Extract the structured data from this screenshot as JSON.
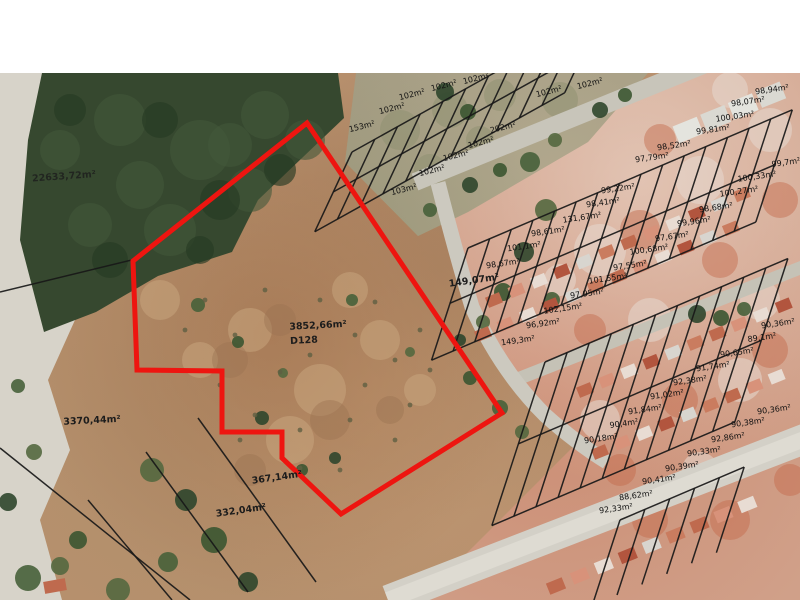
{
  "map": {
    "description": "aerial cadastral map",
    "subject_parcel": {
      "area_label": "3852,66m²",
      "code": "D128",
      "outline_color": "#ee1510",
      "outline_points": "307,123 133,261 137,370 222,371 222,432 282,432 282,458 341,514 502,413"
    },
    "parcel_line_color": "#181818",
    "labels": [
      {
        "text": "22633,72m²",
        "x": 64,
        "y": 177,
        "rot": -4,
        "big": true,
        "dim": true
      },
      {
        "text": "3370,44m²",
        "x": 92,
        "y": 421,
        "rot": -3,
        "big": true
      },
      {
        "text": "3852,66m²",
        "x": 318,
        "y": 326,
        "rot": -3,
        "big": true
      },
      {
        "text": "D128",
        "x": 304,
        "y": 341,
        "rot": -3,
        "big": true
      },
      {
        "text": "367,14m²",
        "x": 277,
        "y": 478,
        "rot": -8,
        "big": true
      },
      {
        "text": "332,04m²",
        "x": 241,
        "y": 511,
        "rot": -8,
        "big": true
      },
      {
        "text": "153m²",
        "x": 362,
        "y": 127,
        "rot": -14
      },
      {
        "text": "102m²",
        "x": 392,
        "y": 109,
        "rot": -14
      },
      {
        "text": "102m²",
        "x": 412,
        "y": 95,
        "rot": -14
      },
      {
        "text": "102m²",
        "x": 444,
        "y": 86,
        "rot": -14
      },
      {
        "text": "102m²",
        "x": 476,
        "y": 79,
        "rot": -14
      },
      {
        "text": "102m²",
        "x": 549,
        "y": 92,
        "rot": -14
      },
      {
        "text": "102m²",
        "x": 590,
        "y": 84,
        "rot": -14
      },
      {
        "text": "202m²",
        "x": 503,
        "y": 128,
        "rot": -14
      },
      {
        "text": "102m²",
        "x": 481,
        "y": 143,
        "rot": -14
      },
      {
        "text": "102m²",
        "x": 456,
        "y": 156,
        "rot": -14
      },
      {
        "text": "102m²",
        "x": 432,
        "y": 171,
        "rot": -14
      },
      {
        "text": "103m²",
        "x": 404,
        "y": 190,
        "rot": -14
      },
      {
        "text": "98,94m²",
        "x": 772,
        "y": 90,
        "rot": -8
      },
      {
        "text": "98,07m²",
        "x": 748,
        "y": 102,
        "rot": -8
      },
      {
        "text": "100,03m²",
        "x": 735,
        "y": 117,
        "rot": -8
      },
      {
        "text": "99,81m²",
        "x": 713,
        "y": 130,
        "rot": -8
      },
      {
        "text": "98,52m²",
        "x": 674,
        "y": 146,
        "rot": -8
      },
      {
        "text": "97,79m²",
        "x": 652,
        "y": 158,
        "rot": -8
      },
      {
        "text": "99,7m²",
        "x": 786,
        "y": 163,
        "rot": -8
      },
      {
        "text": "100,33m²",
        "x": 757,
        "y": 177,
        "rot": -8
      },
      {
        "text": "100,27m²",
        "x": 739,
        "y": 192,
        "rot": -8
      },
      {
        "text": "98,68m²",
        "x": 716,
        "y": 208,
        "rot": -8
      },
      {
        "text": "99,96m²",
        "x": 694,
        "y": 222,
        "rot": -8
      },
      {
        "text": "97,67m²",
        "x": 672,
        "y": 237,
        "rot": -8
      },
      {
        "text": "100,68m²",
        "x": 649,
        "y": 250,
        "rot": -8
      },
      {
        "text": "97,55m²",
        "x": 630,
        "y": 266,
        "rot": -8
      },
      {
        "text": "101,55m²",
        "x": 608,
        "y": 279,
        "rot": -8
      },
      {
        "text": "97,95m²",
        "x": 587,
        "y": 294,
        "rot": -8
      },
      {
        "text": "102,15m²",
        "x": 563,
        "y": 309,
        "rot": -8
      },
      {
        "text": "96,92m²",
        "x": 543,
        "y": 324,
        "rot": -8
      },
      {
        "text": "149,3m²",
        "x": 518,
        "y": 341,
        "rot": -8
      },
      {
        "text": "149,07m²",
        "x": 474,
        "y": 281,
        "rot": -8,
        "big": true
      },
      {
        "text": "98,67m²",
        "x": 503,
        "y": 264,
        "rot": -8
      },
      {
        "text": "101,1m²",
        "x": 524,
        "y": 247,
        "rot": -8
      },
      {
        "text": "98,61m²",
        "x": 548,
        "y": 232,
        "rot": -8
      },
      {
        "text": "131,67m²",
        "x": 582,
        "y": 218,
        "rot": -8
      },
      {
        "text": "98,41m²",
        "x": 603,
        "y": 203,
        "rot": -8
      },
      {
        "text": "99,22m²",
        "x": 618,
        "y": 189,
        "rot": -8
      },
      {
        "text": "90,36m²",
        "x": 778,
        "y": 324,
        "rot": -8
      },
      {
        "text": "89,1m²",
        "x": 762,
        "y": 338,
        "rot": -8
      },
      {
        "text": "90,65m²",
        "x": 737,
        "y": 353,
        "rot": -8
      },
      {
        "text": "91,74m²",
        "x": 713,
        "y": 367,
        "rot": -8
      },
      {
        "text": "92,38m²",
        "x": 690,
        "y": 381,
        "rot": -8
      },
      {
        "text": "91,02m²",
        "x": 667,
        "y": 395,
        "rot": -8
      },
      {
        "text": "91,84m²",
        "x": 645,
        "y": 410,
        "rot": -8
      },
      {
        "text": "90,4m²",
        "x": 624,
        "y": 424,
        "rot": -8
      },
      {
        "text": "90,18m²",
        "x": 601,
        "y": 439,
        "rot": -8
      },
      {
        "text": "90,36m²",
        "x": 774,
        "y": 410,
        "rot": -8
      },
      {
        "text": "90,38m²",
        "x": 748,
        "y": 423,
        "rot": -8
      },
      {
        "text": "92,86m²",
        "x": 728,
        "y": 438,
        "rot": -8
      },
      {
        "text": "90,33m²",
        "x": 704,
        "y": 452,
        "rot": -8
      },
      {
        "text": "90,39m²",
        "x": 682,
        "y": 467,
        "rot": -8
      },
      {
        "text": "90,41m²",
        "x": 659,
        "y": 480,
        "rot": -8
      },
      {
        "text": "88,62m²",
        "x": 636,
        "y": 496,
        "rot": -8
      },
      {
        "text": "92,33m²",
        "x": 616,
        "y": 509,
        "rot": -8
      }
    ]
  }
}
